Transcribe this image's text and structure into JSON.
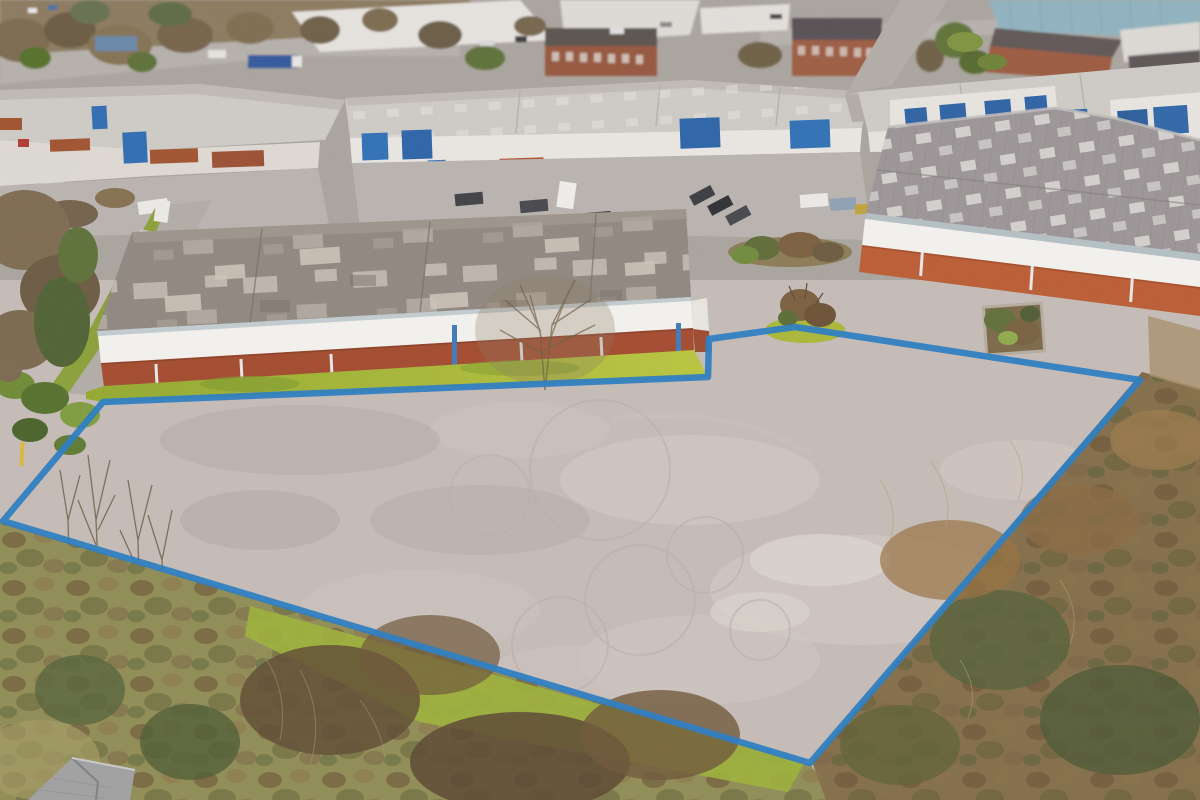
{
  "scene": {
    "description": "Aerial drone photograph of an industrial estate in winter; a large vacant tarmac plot in the foreground is outlined with a thick blue property-boundary line. Warehouses with grey roofs and red-brick walls sit behind the plot, with smaller industrial units, parked cars and roads beyond, and brown winter scrub vegetation bordering the plot on the left, right and bottom. A grey tiled house roof pokes into the bottom-left corner.",
    "type": "aerial-photograph",
    "conditions": "overcast daylight, winter"
  },
  "colors": {
    "boundary_blue": "#2a7cc1",
    "lot_tarmac": "#c5bbb7",
    "apron_tarmac": "#b9b3af",
    "road_grey": "#b2aca7",
    "left_warehouse_roof": "#8f8780",
    "fascia_white": "#f4f2ee",
    "brick_left": "#a34a2e",
    "brick_right": "#bb5c33",
    "right_warehouse_roof": "#9b9597",
    "unit_roof": "#cecac5",
    "door_blue": "#2f6cb3",
    "grass_green": "#9fb134",
    "scrub_olive": "#8f8c55",
    "scrub_brown_right": "#836d49",
    "distant_teal_building": "#8fb2bf",
    "house_roof_grey": "#a0a0a2"
  },
  "boundary": {
    "points": "3,521 103,402 708,377 709,339 795,327 1140,380 810,763",
    "stroke_width": "6.5",
    "shape": "irregular seven-vertex polygon around the vacant plot"
  }
}
